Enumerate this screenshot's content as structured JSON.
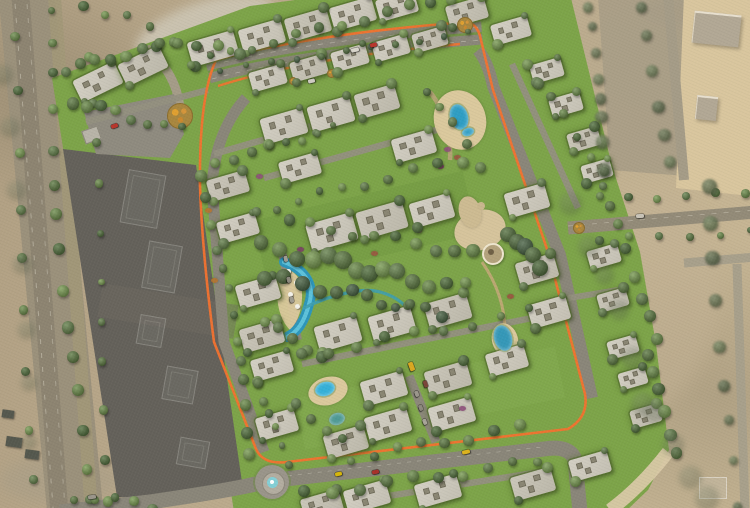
{
  "view": {
    "width": 750,
    "height": 508,
    "kind": "aerial-masterplan-render-over-satellite"
  },
  "palette": {
    "sand_base": "#bdac8e",
    "compound_green": "#7da449",
    "road_gray": "#8a8679",
    "track_orange": "#f3722f",
    "construction_plot": "#64615a",
    "water_blue": "#2f9ec4",
    "deck_tan": "#dbc99d",
    "villa_roof": "#cbc7ba",
    "tree_mix": [
      "#4d6c2f",
      "#5d8038",
      "#3f5f28",
      "#6b9040",
      "#547338"
    ],
    "tree_dark": [
      "#3d5a28",
      "#35512f",
      "#44622c"
    ],
    "tree_desert": [
      "#55663d",
      "#5e7244",
      "#4a5c36"
    ],
    "tree_smudge": [
      "#4e5c3c"
    ]
  },
  "patches": [
    [
      205,
      28,
      72,
      26,
      -18,
      "#cdc6b4",
      0.9,
      5
    ],
    [
      700,
      12,
      58,
      16,
      0,
      "#9a9688",
      0.75,
      4
    ],
    [
      648,
      300,
      70,
      110,
      6,
      "#c3b294",
      0.5,
      8
    ],
    [
      60,
      480,
      60,
      24,
      0,
      "#a99e87",
      0.6,
      6
    ]
  ],
  "svg_shapes": [
    {
      "name": "west-corridor",
      "d": "M26,-10 L76,520",
      "stroke": "#9b917b",
      "width": 56
    },
    {
      "name": "west-road-1",
      "d": "M20,-10 L60,520",
      "stroke": "#8d8471",
      "width": 18
    },
    {
      "name": "west-road-2",
      "d": "M54,-10 L92,520",
      "stroke": "#a29878",
      "width": 13,
      "opacity": 0.9
    },
    {
      "name": "west-lane-dash-1",
      "d": "M14,-10 L54,520",
      "stroke": "#d8d2c2",
      "width": 1,
      "dash": "5,9",
      "opacity": 0.5
    },
    {
      "name": "west-lane-dash-2",
      "d": "M26,-10 L66,520",
      "stroke": "#d8d2c2",
      "width": 1,
      "dash": "5,9",
      "opacity": 0.4
    },
    {
      "name": "ne-gray-zone",
      "d": "M598,-4 L692,-4 L686,176 L610,170 Z",
      "fill": "#a89d86",
      "opacity": 0.9
    },
    {
      "name": "ne-sand-plot",
      "d": "M684,-6 L756,-4 L750,196 L676,188 Z",
      "fill": "#d9c69e"
    },
    {
      "name": "ne-plot-road",
      "d": "M668,-6 L684,180",
      "stroke": "#a59c87",
      "width": 10
    },
    {
      "name": "right-road-h",
      "d": "M684,263 L756,257",
      "stroke": "#a8a08b",
      "width": 9
    },
    {
      "name": "right-road-v",
      "d": "M737,264 L745,512",
      "stroke": "#a8a08b",
      "width": 9
    },
    {
      "name": "compound-green",
      "d": "M52,78 L250,6 L340,-6 L570,-6 L612,166 L640,252 L656,344 L669,450 L648,490 L625,512 L234,512 L227,466 L203,340 L199,180 L64,154 Z",
      "fill": "#7da449"
    },
    {
      "name": "green-shade-1",
      "d": "M260,252 L470,202",
      "stroke": "#6e963e",
      "width": 64,
      "opacity": 0.35
    },
    {
      "name": "green-shade-2",
      "d": "M300,424 L560,372",
      "stroke": "#8cb257",
      "width": 52,
      "opacity": 0.3
    },
    {
      "name": "green-shade-3",
      "d": "M110,92 L400,22",
      "stroke": "#739a42",
      "width": 42,
      "opacity": 0.3
    },
    {
      "name": "construction-plot",
      "d": "M63,149 L196,165 L243,489 L196,500 L117,497 Z",
      "fill": "#64615a"
    },
    {
      "name": "construction-plot-streak",
      "d": "M100,300 L236,322",
      "stroke": "#6e6a61",
      "width": 34,
      "opacity": 0.45
    },
    {
      "name": "entry-road",
      "d": "M146,48 Q176,72 180,108",
      "stroke": "#a59c88",
      "width": 9
    },
    {
      "name": "entry-plaza",
      "d": "M84,112 L174,94 L184,134 L170,158 L96,154 Z",
      "fill": "#8f8b7f"
    },
    {
      "name": "north-boulevard",
      "d": "M208,72 Q300,47 482,33",
      "stroke": "#8a8679",
      "width": 23
    },
    {
      "name": "boulevard-median",
      "d": "M208,72 Q300,47 482,33",
      "stroke": "#6f9540",
      "width": 2.4,
      "opacity": 0.85
    },
    {
      "name": "boulevard-dash-n",
      "d": "M212,65 Q305,41 482,27",
      "stroke": "#d8d4c8",
      "width": 0.8,
      "dash": "5,7",
      "opacity": 0.5
    },
    {
      "name": "boulevard-dash-s",
      "d": "M212,79 Q302,54 482,40",
      "stroke": "#d8d4c8",
      "width": 0.8,
      "dash": "5,7",
      "opacity": 0.5
    },
    {
      "name": "east-ring-road",
      "d": "M478,50 Q488,62 493,86 L560,255 L592,398",
      "stroke": "#8a8679",
      "width": 12
    },
    {
      "name": "south-ring-road",
      "d": "M60,512 L150,502 Q240,489 268,481 L544,449 Q570,445 575,460 L580,512",
      "stroke": "#8a8679",
      "width": 15
    },
    {
      "name": "west-ring-road",
      "d": "M246,98 Q216,130 212,185 L224,342 L264,452",
      "stroke": "#8a8679",
      "width": 11
    },
    {
      "name": "south-lane-dash",
      "d": "M268,478 L542,447",
      "stroke": "#d8d4c8",
      "width": 0.7,
      "dash": "4,6",
      "opacity": 0.45
    },
    {
      "name": "east-exit-road",
      "d": "M568,228 L756,212",
      "stroke": "#938b78",
      "width": 13
    },
    {
      "name": "east-exit-dash",
      "d": "M568,226 L756,210",
      "stroke": "#dcd6c6",
      "width": 0.7,
      "dash": "5,7",
      "opacity": 0.5
    },
    {
      "name": "street-1",
      "d": "M86,122 L208,90",
      "stroke": "#94907f",
      "width": 6.5,
      "opacity": 0.95
    },
    {
      "name": "street-2",
      "d": "M214,154 L332,120",
      "stroke": "#94907f",
      "width": 6.5,
      "opacity": 0.95
    },
    {
      "name": "street-3",
      "d": "M264,178 L458,124",
      "stroke": "#94907f",
      "width": 6.5,
      "opacity": 0.95
    },
    {
      "name": "street-4",
      "d": "M302,364 L532,318",
      "stroke": "#94907f",
      "width": 6.5,
      "opacity": 0.95
    },
    {
      "name": "parking-aisle-1",
      "d": "M282,252 L298,340",
      "stroke": "#8c887a",
      "width": 8
    },
    {
      "name": "parking-aisle-2",
      "d": "M409,376 L436,442",
      "stroke": "#8c887a",
      "width": 9
    },
    {
      "name": "street-5",
      "d": "M512,64 L578,208",
      "stroke": "#94907f",
      "width": 6.5,
      "opacity": 0.95
    },
    {
      "name": "street-6",
      "d": "M350,502 L540,472",
      "stroke": "#94907f",
      "width": 6.5,
      "opacity": 0.95
    },
    {
      "name": "street-7",
      "d": "M545,302 L618,290",
      "stroke": "#94907f",
      "width": 6,
      "opacity": 0.95
    },
    {
      "name": "clubhouse-path",
      "d": "M482,262 Q505,295 505,332",
      "stroke": "#c2a977",
      "width": 3,
      "opacity": 0.9
    },
    {
      "name": "pool-path",
      "d": "M430,92 Q452,120 450,160",
      "stroke": "#b7a478",
      "width": 4.5,
      "opacity": 0.9
    },
    {
      "name": "jogging-track-loop",
      "d": "M216,60 Q310,34 468,22 Q477,25 480,36 L493,90 L548,252 L585,394 Q589,417 568,429 L287,462 Q263,465 256,449 L214,342 Q202,250 200,186 Q199,96 216,60 Z",
      "stroke": "#f3722f",
      "width": 2.6,
      "opacity": 0.95
    },
    {
      "name": "jogging-track-inner",
      "d": "M218,86 Q305,58 460,44",
      "stroke": "#f3722f",
      "width": 2.4,
      "opacity": 0.9
    },
    {
      "name": "lagoon-deck",
      "d": "M281,270 Q300,268 302,292 Q303,316 290,330 Q278,318 277,294 Q277,276 281,270 Z",
      "fill": "#dbc99d",
      "opacity": 0.95
    },
    {
      "name": "lagoon-outer",
      "d": "M284,262 C306,270 315,286 309,304 C304,324 296,333 287,337",
      "stroke": "#2d96ba",
      "width": 10,
      "cap": "round"
    },
    {
      "name": "lagoon-inner",
      "d": "M284,262 C306,270 315,286 309,304 C304,324 296,333 287,337",
      "stroke": "#64c6de",
      "width": 4,
      "opacity": 0.9,
      "cap": "round"
    },
    {
      "name": "park-stream",
      "d": "M304,308 C336,292 364,289 375,291 C388,293 398,299 404,305",
      "stroke": "#3f9fae",
      "width": 3.2,
      "opacity": 0.9,
      "cap": "round"
    },
    {
      "name": "beach-rim",
      "d": "M610,510 Q640,488 668,452",
      "stroke": "#d9c9a6",
      "width": 13,
      "opacity": 0.95
    }
  ],
  "decks": [
    [
      460,
      120,
      26,
      30,
      -16
    ],
    [
      328,
      391,
      20,
      14,
      -16
    ],
    [
      505,
      340,
      13,
      17,
      -16
    ]
  ],
  "footprints": [
    [
      142,
      198,
      36,
      52,
      10
    ],
    [
      161,
      266,
      32,
      46,
      10
    ],
    [
      150,
      330,
      24,
      28,
      10
    ],
    [
      179,
      384,
      30,
      32,
      10
    ],
    [
      192,
      452,
      28,
      26,
      10
    ]
  ],
  "villas": [
    [
      98,
      82,
      46,
      24,
      -26
    ],
    [
      143,
      66,
      46,
      24,
      -26
    ],
    [
      213,
      48,
      48,
      25,
      -16
    ],
    [
      262,
      36,
      44,
      24,
      -16
    ],
    [
      308,
      25,
      44,
      24,
      -16
    ],
    [
      353,
      14,
      44,
      24,
      -16
    ],
    [
      397,
      6,
      40,
      22,
      -16
    ],
    [
      467,
      12,
      40,
      22,
      -16
    ],
    [
      511,
      30,
      38,
      21,
      -16
    ],
    [
      268,
      78,
      36,
      20,
      -16
    ],
    [
      309,
      68,
      36,
      20,
      -16
    ],
    [
      350,
      58,
      36,
      20,
      -16
    ],
    [
      391,
      48,
      36,
      20,
      -16
    ],
    [
      430,
      39,
      34,
      19,
      -16
    ],
    [
      547,
      70,
      32,
      19,
      -16
    ],
    [
      566,
      104,
      32,
      19,
      -16
    ],
    [
      584,
      139,
      32,
      19,
      -16
    ],
    [
      597,
      171,
      30,
      18,
      -16
    ],
    [
      604,
      256,
      32,
      19,
      -16
    ],
    [
      613,
      300,
      30,
      18,
      -16
    ],
    [
      623,
      347,
      30,
      18,
      -16
    ],
    [
      633,
      378,
      28,
      17,
      -16
    ],
    [
      646,
      416,
      30,
      18,
      -16
    ],
    [
      284,
      126,
      44,
      26,
      -16
    ],
    [
      331,
      114,
      44,
      26,
      -16
    ],
    [
      377,
      101,
      42,
      25,
      -16
    ],
    [
      300,
      168,
      40,
      22,
      -16
    ],
    [
      414,
      146,
      42,
      24,
      -16
    ],
    [
      228,
      186,
      40,
      22,
      -16
    ],
    [
      238,
      228,
      40,
      22,
      -16
    ],
    [
      332,
      232,
      48,
      28,
      -16
    ],
    [
      382,
      220,
      48,
      28,
      -16
    ],
    [
      432,
      210,
      42,
      25,
      -16
    ],
    [
      527,
      200,
      42,
      25,
      -16
    ],
    [
      537,
      270,
      40,
      24,
      -16
    ],
    [
      549,
      312,
      40,
      24,
      -16
    ],
    [
      258,
      292,
      42,
      24,
      -16
    ],
    [
      262,
      336,
      42,
      24,
      -16
    ],
    [
      338,
      334,
      44,
      26,
      -16
    ],
    [
      392,
      324,
      44,
      26,
      -16
    ],
    [
      448,
      311,
      44,
      26,
      -16
    ],
    [
      272,
      366,
      40,
      22,
      -16
    ],
    [
      277,
      424,
      40,
      23,
      -16
    ],
    [
      346,
      442,
      42,
      24,
      -16
    ],
    [
      384,
      388,
      44,
      25,
      -16
    ],
    [
      388,
      424,
      44,
      25,
      -16
    ],
    [
      448,
      378,
      44,
      25,
      -16
    ],
    [
      452,
      414,
      44,
      25,
      -16
    ],
    [
      507,
      360,
      40,
      23,
      -16
    ],
    [
      322,
      505,
      40,
      22,
      -16
    ],
    [
      367,
      497,
      44,
      24,
      -16
    ],
    [
      438,
      491,
      44,
      24,
      -16
    ],
    [
      533,
      484,
      42,
      24,
      -16
    ],
    [
      590,
      466,
      40,
      22,
      -16
    ]
  ],
  "sat_buildings": [
    [
      716,
      28,
      46,
      30,
      6
    ],
    [
      706,
      107,
      20,
      22,
      6
    ]
  ],
  "pads": [
    [
      712,
      487,
      26,
      20,
      0
    ]
  ],
  "sheds": [
    [
      14,
      442,
      16,
      10,
      8
    ],
    [
      32,
      454,
      14,
      9,
      8
    ],
    [
      8,
      414,
      12,
      8,
      8
    ]
  ],
  "huts": [
    [
      90,
      134,
      15,
      12,
      -20
    ]
  ],
  "tree_rows": [
    [
      46,
      6,
      84,
      500,
      15,
      5,
      6,
      "mix"
    ],
    [
      8,
      40,
      40,
      480,
      9,
      4,
      7,
      "mix"
    ],
    [
      82,
      10,
      114,
      500,
      12,
      4.5,
      6,
      "mix"
    ],
    [
      112,
      14,
      232,
      58,
      7,
      5,
      8,
      "mix"
    ],
    [
      66,
      70,
      178,
      42,
      8,
      4.5,
      4,
      "mix"
    ],
    [
      72,
      100,
      184,
      130,
      8,
      5,
      5,
      "mix"
    ],
    [
      192,
      64,
      448,
      -4,
      13,
      4.5,
      4,
      "mix"
    ],
    [
      220,
      70,
      470,
      33,
      11,
      2.8,
      2,
      "dark"
    ],
    [
      214,
      162,
      334,
      128,
      8,
      4,
      4,
      "mix"
    ],
    [
      254,
      212,
      462,
      160,
      10,
      4.5,
      5,
      "mix"
    ],
    [
      258,
      248,
      468,
      288,
      14,
      7,
      7,
      "mix"
    ],
    [
      264,
      278,
      448,
      314,
      12,
      6,
      6,
      "dark"
    ],
    [
      294,
      222,
      470,
      254,
      10,
      5.5,
      5,
      "mix"
    ],
    [
      268,
      322,
      324,
      356,
      5,
      5,
      4,
      "mix"
    ],
    [
      306,
      356,
      524,
      312,
      9,
      4.5,
      5,
      "mix"
    ],
    [
      262,
      382,
      288,
      462,
      6,
      4.5,
      4,
      "mix"
    ],
    [
      348,
      458,
      524,
      428,
      8,
      4.5,
      5,
      "mix"
    ],
    [
      302,
      494,
      542,
      462,
      10,
      5,
      5,
      "mix"
    ],
    [
      532,
      62,
      602,
      172,
      7,
      5,
      5,
      "mix"
    ],
    [
      608,
      182,
      652,
      342,
      8,
      5,
      5,
      "mix"
    ],
    [
      652,
      352,
      674,
      452,
      6,
      5,
      4,
      "mix"
    ],
    [
      206,
      178,
      252,
      452,
      13,
      5,
      5,
      "mix"
    ],
    [
      432,
      88,
      480,
      164,
      5,
      5,
      5,
      "mix"
    ],
    [
      504,
      232,
      540,
      266,
      5,
      6.5,
      4,
      "dark"
    ],
    [
      300,
      406,
      344,
      440,
      4,
      4.5,
      4,
      "mix"
    ],
    [
      70,
      496,
      150,
      506,
      5,
      5,
      5,
      "mix"
    ],
    [
      600,
      198,
      748,
      194,
      6,
      3.5,
      3,
      "mix"
    ],
    [
      602,
      240,
      748,
      232,
      6,
      3.5,
      3,
      "mix"
    ],
    [
      585,
      8,
      606,
      166,
      8,
      6,
      5,
      "desert"
    ],
    [
      646,
      8,
      666,
      166,
      6,
      5,
      5,
      "desert"
    ],
    [
      714,
      182,
      732,
      504,
      9,
      6,
      6,
      "desert"
    ],
    [
      566,
      200,
      638,
      396,
      6,
      12,
      10,
      "smudge"
    ],
    [
      648,
      418,
      700,
      498,
      4,
      10,
      8,
      "smudge"
    ],
    [
      6,
      70,
      22,
      450,
      7,
      8,
      10,
      "smudge"
    ]
  ],
  "water": [
    [
      459,
      117,
      9,
      13,
      -16,
      "#2f9ec4"
    ],
    [
      468,
      132,
      6,
      4,
      -16,
      "#2f9ec4"
    ],
    [
      325,
      389,
      10,
      7,
      -16,
      "#35b0d8"
    ],
    [
      337,
      419,
      8,
      6,
      -16,
      "#4f9a94"
    ],
    [
      503,
      338,
      9,
      13,
      -16,
      "#3598b8"
    ]
  ],
  "flower_circles": [
    [
      179,
      115,
      12
    ],
    [
      464,
      24,
      7
    ],
    [
      578,
      227,
      5
    ],
    [
      330,
      72,
      3.5
    ],
    [
      292,
      80,
      3
    ]
  ],
  "roundabouts": [
    [
      272,
      482
    ]
  ],
  "clubhouse": {
    "blobs": [
      [
        480,
        230,
        26,
        20,
        -16,
        "#d6c49c"
      ],
      [
        470,
        212,
        11,
        16,
        -16,
        "#cdbb92"
      ]
    ],
    "ring": [
      491,
      252,
      9
    ],
    "dots": [
      [
        491,
        252,
        3,
        "#6f6046"
      ],
      [
        481,
        206,
        4,
        "#c9b78e"
      ]
    ]
  },
  "umbrellas": [
    [
      288,
      271
    ],
    [
      296,
      282
    ],
    [
      290,
      294
    ],
    [
      297,
      306
    ]
  ],
  "shrubs": [
    [
      259,
      176,
      "#8e4f7a"
    ],
    [
      300,
      249,
      "#7a3f63"
    ],
    [
      330,
      257,
      "#9a5540"
    ],
    [
      353,
      267,
      "#8e4f7a"
    ],
    [
      374,
      253,
      "#9a5540"
    ],
    [
      418,
      230,
      "#7a3f63"
    ],
    [
      447,
      149,
      "#8e4f7a"
    ],
    [
      457,
      157,
      "#9a5540"
    ],
    [
      440,
      166,
      "#7a3f63"
    ],
    [
      462,
      408,
      "#8e4f7a"
    ],
    [
      510,
      296,
      "#9a5540"
    ],
    [
      208,
      210,
      "#b5742e"
    ],
    [
      214,
      280,
      "#b5742e"
    ],
    [
      292,
      256,
      "#c46a35"
    ]
  ],
  "cars": [
    [
      114,
      126,
      7,
      4,
      -20,
      "#b8362c"
    ],
    [
      355,
      50,
      8,
      4,
      -14,
      "#d9d6cb"
    ],
    [
      373,
      45,
      7,
      4,
      -14,
      "#b8362c"
    ],
    [
      311,
      81,
      7,
      4,
      -14,
      "#cfccc2"
    ],
    [
      411,
      366,
      9,
      5,
      70,
      "#d9a821"
    ],
    [
      425,
      384,
      7,
      4,
      70,
      "#7a4438"
    ],
    [
      466,
      452,
      8,
      4,
      -12,
      "#ddb31d"
    ],
    [
      338,
      474,
      7,
      4,
      -12,
      "#d6b60a"
    ],
    [
      375,
      472,
      7,
      4,
      -12,
      "#a83029"
    ],
    [
      286,
      259,
      6,
      3.5,
      78,
      "#a09c90"
    ],
    [
      289,
      280,
      6,
      3.5,
      78,
      "#8d897d"
    ],
    [
      292,
      300,
      6,
      3.5,
      78,
      "#a09c90"
    ],
    [
      417,
      394,
      6,
      3.5,
      70,
      "#9b978b"
    ],
    [
      421,
      408,
      6,
      3.5,
      70,
      "#8d897d"
    ],
    [
      425,
      422,
      6,
      3.5,
      70,
      "#a8a498"
    ],
    [
      640,
      216,
      8,
      4,
      -4,
      "#c9c4b8"
    ],
    [
      92,
      497,
      8,
      4,
      -8,
      "#9a958a"
    ]
  ]
}
